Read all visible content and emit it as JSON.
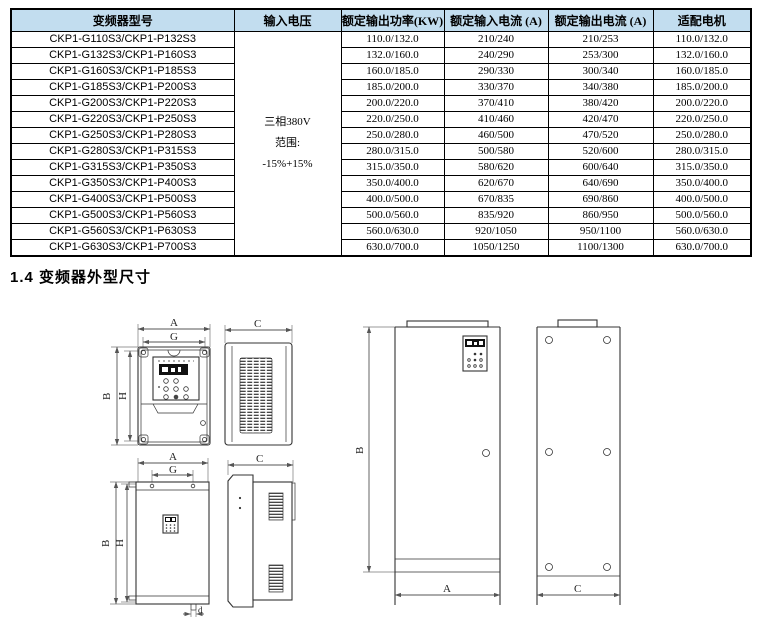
{
  "table": {
    "header_bg": "#c2ddef",
    "headers": [
      "变频器型号",
      "输入电压",
      "额定输出功率(KW)",
      "额定输入电流 (A)",
      "额定输出电流 (A)",
      "适配电机"
    ],
    "voltage": {
      "line1": "三相380V",
      "line2": "范围:",
      "line3": "-15%+15%"
    },
    "rows": [
      {
        "model": "CKP1-G110S3/CKP1-P132S3",
        "power": "110.0/132.0",
        "input_current": "210/240",
        "output_current": "210/253",
        "motor": "110.0/132.0"
      },
      {
        "model": "CKP1-G132S3/CKP1-P160S3",
        "power": "132.0/160.0",
        "input_current": "240/290",
        "output_current": "253/300",
        "motor": "132.0/160.0"
      },
      {
        "model": "CKP1-G160S3/CKP1-P185S3",
        "power": "160.0/185.0",
        "input_current": "290/330",
        "output_current": "300/340",
        "motor": "160.0/185.0"
      },
      {
        "model": "CKP1-G185S3/CKP1-P200S3",
        "power": "185.0/200.0",
        "input_current": "330/370",
        "output_current": "340/380",
        "motor": "185.0/200.0"
      },
      {
        "model": "CKP1-G200S3/CKP1-P220S3",
        "power": "200.0/220.0",
        "input_current": "370/410",
        "output_current": "380/420",
        "motor": "200.0/220.0"
      },
      {
        "model": "CKP1-G220S3/CKP1-P250S3",
        "power": "220.0/250.0",
        "input_current": "410/460",
        "output_current": "420/470",
        "motor": "220.0/250.0"
      },
      {
        "model": "CKP1-G250S3/CKP1-P280S3",
        "power": "250.0/280.0",
        "input_current": "460/500",
        "output_current": "470/520",
        "motor": "250.0/280.0"
      },
      {
        "model": "CKP1-G280S3/CKP1-P315S3",
        "power": "280.0/315.0",
        "input_current": "500/580",
        "output_current": "520/600",
        "motor": "280.0/315.0"
      },
      {
        "model": "CKP1-G315S3/CKP1-P350S3",
        "power": "315.0/350.0",
        "input_current": "580/620",
        "output_current": "600/640",
        "motor": "315.0/350.0"
      },
      {
        "model": "CKP1-G350S3/CKP1-P400S3",
        "power": "350.0/400.0",
        "input_current": "620/670",
        "output_current": "640/690",
        "motor": "350.0/400.0"
      },
      {
        "model": "CKP1-G400S3/CKP1-P500S3",
        "power": "400.0/500.0",
        "input_current": "670/835",
        "output_current": "690/860",
        "motor": "400.0/500.0"
      },
      {
        "model": "CKP1-G500S3/CKP1-P560S3",
        "power": "500.0/560.0",
        "input_current": "835/920",
        "output_current": "860/950",
        "motor": "500.0/560.0"
      },
      {
        "model": "CKP1-G560S3/CKP1-P630S3",
        "power": "560.0/630.0",
        "input_current": "920/1050",
        "output_current": "950/1100",
        "motor": "560.0/630.0"
      },
      {
        "model": "CKP1-G630S3/CKP1-P700S3",
        "power": "630.0/700.0",
        "input_current": "1050/1250",
        "output_current": "1100/1300",
        "motor": "630.0/700.0"
      }
    ]
  },
  "section": {
    "title": "1.4 变频器外型尺寸"
  },
  "diagram": {
    "labels": {
      "A": "A",
      "G": "G",
      "B": "B",
      "H": "H",
      "C": "C",
      "d": "d"
    }
  }
}
